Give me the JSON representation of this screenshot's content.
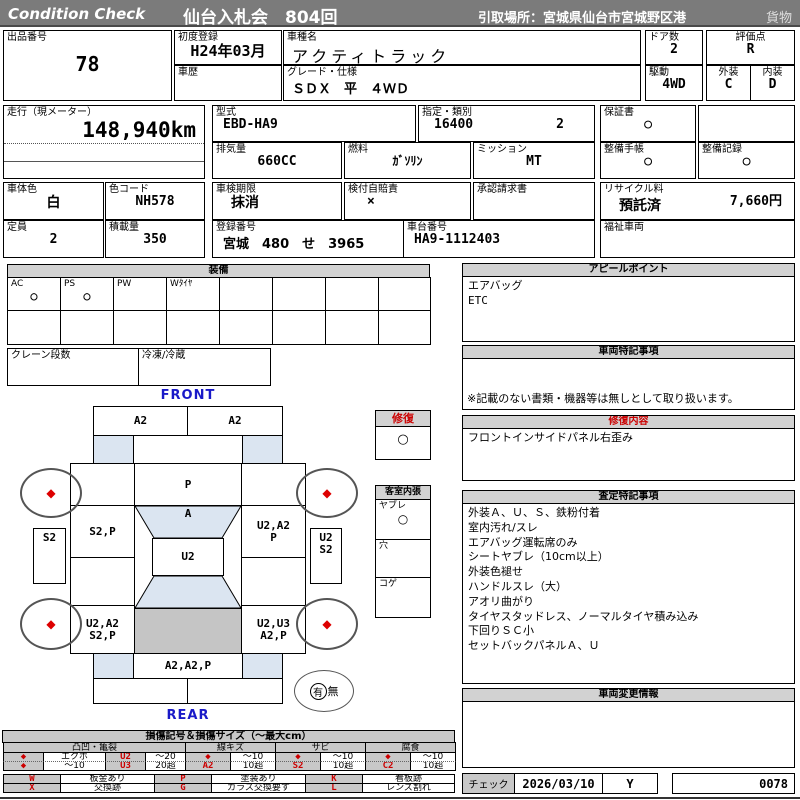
{
  "header": {
    "brand": "Condition  Check",
    "title": "仙台入札会　804回",
    "pickup": "引取場所：宮城県仙台市宮城野区港",
    "category": "貨物"
  },
  "info": {
    "lot_label": "出品番号",
    "lot": "78",
    "first_reg_label": "初度登録",
    "first_reg": "H24年03月",
    "model_label": "車種名",
    "model": "アクティトラック",
    "history_label": "車歴",
    "history": "",
    "grade_label": "グレード・仕様",
    "grade": "ＳＤＸ　平　４ＷＤ",
    "doors_label": "ドア数",
    "doors": "2",
    "score_label": "評価点",
    "score": "R",
    "drive_label": "駆動",
    "drive": "4WD",
    "ext_label": "外装",
    "ext": "C",
    "int_label": "内装",
    "int": "D"
  },
  "spec": {
    "mileage_label": "走行（現メーター）",
    "mileage": "148,940km",
    "model_code_label": "型式",
    "model_code": "EBD-HA9",
    "class_label": "指定・類別",
    "class1": "16400",
    "class2": "2",
    "disp_label": "排気量",
    "disp": "660CC",
    "fuel_label": "燃料",
    "fuel": "ｶﾞｿﾘﾝ",
    "mission_label": "ミッション",
    "mission": "MT",
    "warranty_label": "保証書",
    "warranty": "○",
    "book_label": "整備手帳",
    "book": "○",
    "record_label": "整備記録",
    "record": "○",
    "body_color_label": "車体色",
    "body_color": "白",
    "color_code_label": "色コード",
    "color_code": "NH578",
    "inspection_label": "車検期限",
    "inspection": "抹消",
    "insurance_label": "検付自賠責",
    "insurance": "×",
    "approval_label": "承認請求書",
    "approval": "",
    "capacity_label": "定員",
    "capacity": "2",
    "load_label": "積載量",
    "load": "350",
    "reg_label": "登録番号",
    "reg": "宮城　480　せ　3965",
    "chassis_label": "車台番号",
    "chassis": "HA9-1112403",
    "recycle_label": "リサイクル料",
    "recycle_status": "預託済",
    "recycle_fee": "7,660円",
    "welfare_label": "福祉車両",
    "welfare": ""
  },
  "equipment": {
    "title": "装備",
    "cells": [
      {
        "label": "AC",
        "mark": "○"
      },
      {
        "label": "PS",
        "mark": "○"
      },
      {
        "label": "PW",
        "mark": ""
      },
      {
        "label": "Wﾀｲﾔ",
        "mark": ""
      },
      {
        "label": "",
        "mark": ""
      },
      {
        "label": "",
        "mark": ""
      },
      {
        "label": "",
        "mark": ""
      },
      {
        "label": "",
        "mark": ""
      }
    ],
    "crane_label": "クレーン段数",
    "crane": "",
    "fridge_label": "冷凍/冷蔵",
    "fridge": ""
  },
  "panels": {
    "appeal_title": "アピールポイント",
    "appeal_lines": [
      "エアバッグ",
      "ETC"
    ],
    "notes_title": "車両特記事項",
    "notes_footer": "※記載のない書類・機器等は無しとして取り扱います。",
    "repair_title": "修復内容",
    "repair_line": "フロントインサイドパネル右歪み",
    "assess_title": "査定特記事項",
    "assess_lines": [
      "外装Ａ、Ｕ、Ｓ、鉄粉付着",
      "室内汚れ/スレ",
      "エアバッグ運転席のみ",
      "シートヤブレ（10cm以上）",
      "外装色褪せ",
      "ハンドルスレ（大）",
      "アオリ曲がり",
      "タイヤスタッドレス、ノーマルタイヤ積み込み",
      "下回りＳＣ小",
      "セットバックパネルＡ、Ｕ"
    ],
    "change_title": "車両変更情報"
  },
  "diagram": {
    "front_label": "FRONT",
    "rear_label": "REAR",
    "front_bumper": [
      "A2",
      "A2"
    ],
    "hood": "P",
    "door_left": "S2,P",
    "windshield": "A",
    "roof": "U2",
    "door_right": [
      "U2,A2",
      "P"
    ],
    "mirror_left": "S2",
    "mirror_right": [
      "U2",
      "S2"
    ],
    "rear_left": [
      "U2,A2",
      "S2,P"
    ],
    "rear_right": [
      "U2,U3",
      "A2,P"
    ],
    "tailgate": "A2,A2,P",
    "wheel_mark": "◆",
    "spare_yes": "有",
    "spare_no": "無",
    "repair_box": {
      "title": "修復",
      "mark": "○"
    },
    "cabin_box": {
      "title": "客室内張",
      "items": [
        {
          "label": "ヤブレ",
          "mark": "○"
        },
        {
          "label": "穴",
          "mark": ""
        },
        {
          "label": "コゲ",
          "mark": ""
        }
      ]
    }
  },
  "legend": {
    "title": "損傷記号＆損傷サイズ（～最大cm）",
    "group_headers": [
      "凸凹・亀裂",
      "線キズ",
      "サビ",
      "腐食"
    ],
    "row1": [
      "◆",
      "エクボ",
      "U2",
      "～20",
      "◆",
      "～10",
      "◆",
      "～10",
      "◆",
      "～10"
    ],
    "row2": [
      "◆",
      "～10",
      "U3",
      "20超",
      "A2",
      "10超",
      "S2",
      "10超",
      "C2",
      "10超"
    ],
    "codes_row1": [
      "W",
      "板金あり",
      "P",
      "塗装あり",
      "K",
      "看板跡"
    ],
    "codes_row2": [
      "X",
      "交換跡",
      "G",
      "ガラス交換要す",
      "L",
      "レンズ割れ"
    ]
  },
  "check": {
    "label": "チェック",
    "date": "2026/03/10",
    "mark": "Y",
    "number": "0078"
  },
  "colors": {
    "accent_red": "#cc0000",
    "header_gray": "#7b7b7b",
    "panel_gray": "#d2d2d2",
    "light_blue": "#dbe5f1",
    "bed_gray": "#c5c5c5",
    "label_blue": "#1a1ac8"
  }
}
